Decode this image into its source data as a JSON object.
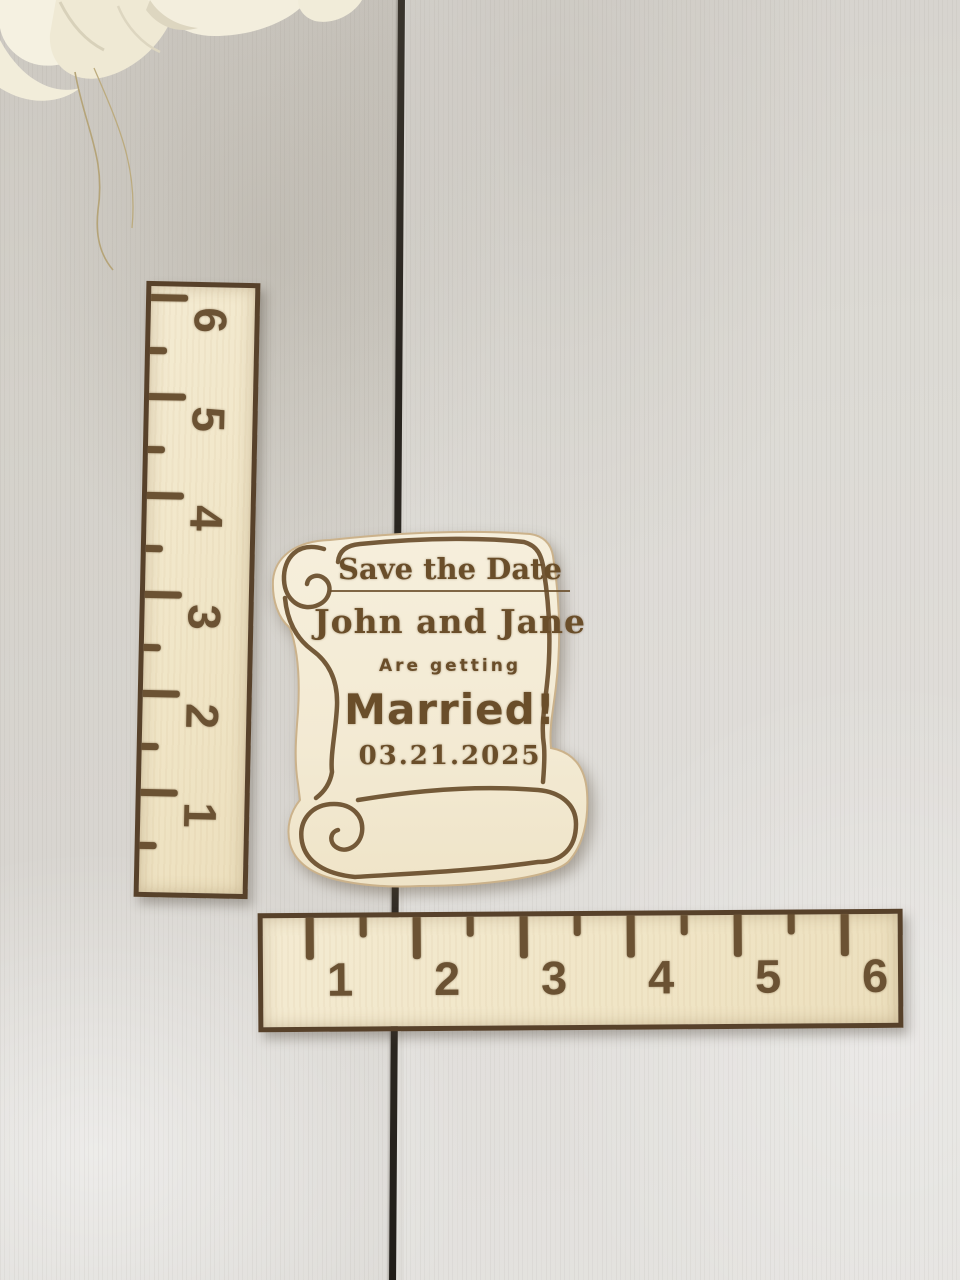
{
  "magnet": {
    "title": "Save the Date",
    "names": "John and Jane",
    "subtitle": "Are getting",
    "headline": "Married!",
    "date": "03.21.2025"
  },
  "vertical_ruler": {
    "unit_numbers": [
      "6",
      "5",
      "4",
      "3",
      "2",
      "1"
    ]
  },
  "horizontal_ruler": {
    "unit_numbers": [
      "1",
      "2",
      "3",
      "4",
      "5",
      "6"
    ]
  },
  "colors": {
    "wood_background": "#d5d2cc",
    "plank_seam": "#2b2722",
    "ruler_wood": "#f2e8cc",
    "ruler_edge": "#57412a",
    "engraving_brown": "#6b5233",
    "magnet_wood": "#f4ecd8",
    "rose_white": "#f4efdf"
  }
}
